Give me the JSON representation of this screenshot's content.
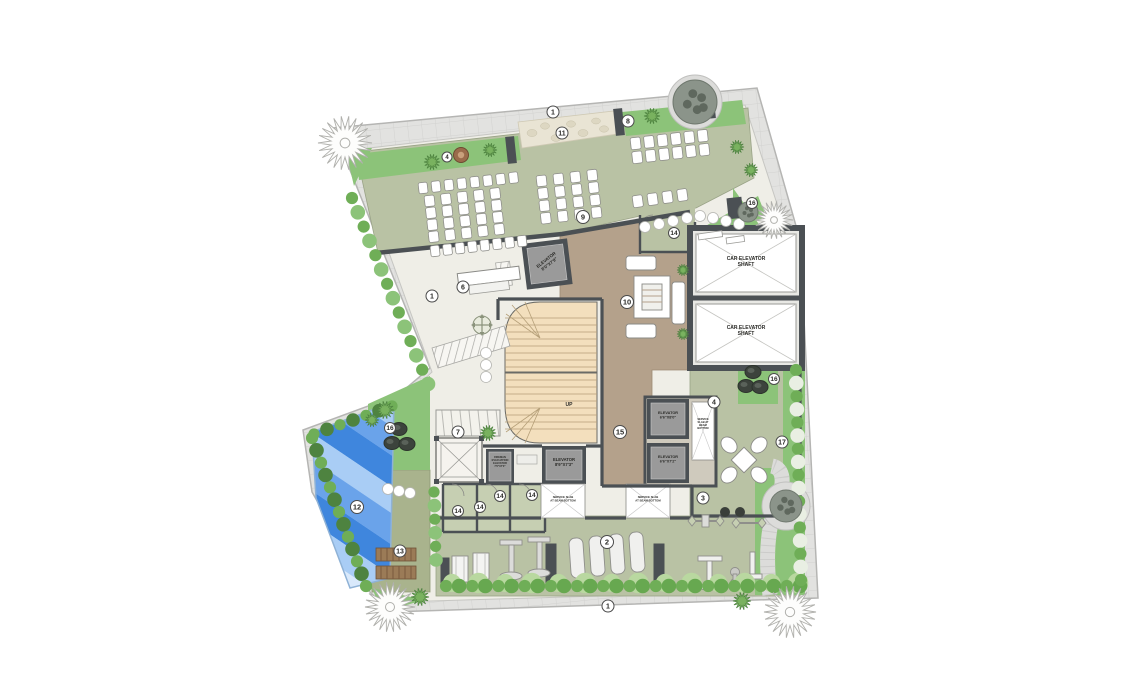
{
  "plan": {
    "type": "architectural-site-floor-plan",
    "colors": {
      "sidewalk": "#e2e2e0",
      "walk": "#efeee7",
      "sage": "#b9c2a4",
      "sage_light": "#c6cfb2",
      "green": "#8cc379",
      "hedge_dark": "#6fae57",
      "hedge_alt": "#4e8340",
      "lawn_ball": "#b9d8a0",
      "tan": "#b4a18b",
      "stairs": "#f3dfbd",
      "wall": "#4b5054",
      "elevator_fill": "#9a9a9a",
      "pool_blues": [
        "#d9e9fb",
        "#a9cdf5",
        "#6aa3ea",
        "#3f86dd"
      ],
      "deck": "#a9b38d",
      "pebble": "#e9e4d4",
      "white": "#ffffff",
      "marker_stroke": "#4a4a4a"
    },
    "markers": [
      {
        "n": "1",
        "x": 553,
        "y": 112,
        "r": 6
      },
      {
        "n": "11",
        "x": 562,
        "y": 133,
        "r": 6
      },
      {
        "n": "8",
        "x": 628,
        "y": 121,
        "r": 6
      },
      {
        "n": "4",
        "x": 447,
        "y": 157,
        "r": 5
      },
      {
        "n": "9",
        "x": 583,
        "y": 217,
        "r": 6.5
      },
      {
        "n": "14",
        "x": 674,
        "y": 233,
        "r": 5.5
      },
      {
        "n": "16",
        "x": 752,
        "y": 203,
        "r": 5.5
      },
      {
        "n": "6",
        "x": 463,
        "y": 287,
        "r": 6
      },
      {
        "n": "1",
        "x": 432,
        "y": 296,
        "r": 6
      },
      {
        "n": "10",
        "x": 627,
        "y": 302,
        "r": 6.5
      },
      {
        "n": "15",
        "x": 620,
        "y": 432,
        "r": 6.5
      },
      {
        "n": "4",
        "x": 714,
        "y": 402,
        "r": 6
      },
      {
        "n": "16",
        "x": 774,
        "y": 379,
        "r": 5.5
      },
      {
        "n": "17",
        "x": 782,
        "y": 442,
        "r": 6
      },
      {
        "n": "14",
        "x": 458,
        "y": 511,
        "r": 5.5
      },
      {
        "n": "14",
        "x": 480,
        "y": 507,
        "r": 5.5
      },
      {
        "n": "14",
        "x": 500,
        "y": 496,
        "r": 5.5
      },
      {
        "n": "14",
        "x": 532,
        "y": 495,
        "r": 5.5
      },
      {
        "n": "3",
        "x": 703,
        "y": 498,
        "r": 6
      },
      {
        "n": "2",
        "x": 607,
        "y": 542,
        "r": 6.5
      },
      {
        "n": "16",
        "x": 390,
        "y": 428,
        "r": 5.5
      },
      {
        "n": "7",
        "x": 458,
        "y": 432,
        "r": 6
      },
      {
        "n": "12",
        "x": 357,
        "y": 507,
        "r": 6.5
      },
      {
        "n": "13",
        "x": 400,
        "y": 551,
        "r": 6
      },
      {
        "n": "1",
        "x": 608,
        "y": 606,
        "r": 6
      }
    ],
    "labels": [
      {
        "id": "car-elevator-shaft-1",
        "text": "CAR ELEVATOR\nSHAFT",
        "x": 746,
        "y": 260,
        "fs": 5,
        "rot": 0
      },
      {
        "id": "car-elevator-shaft-2",
        "text": "CAR ELEVATOR\nSHAFT",
        "x": 746,
        "y": 329,
        "fs": 5,
        "rot": 0
      },
      {
        "id": "elevator-lobby",
        "text": "ELEVATOR\n8'0\"X7'9\"",
        "x": 547,
        "y": 261,
        "fs": 4.4,
        "rot": -38
      },
      {
        "id": "elevator-mid",
        "text": "ELEVATOR\n8'9\"X7'3\"",
        "x": 564,
        "y": 461,
        "fs": 4.2,
        "rot": 0
      },
      {
        "id": "fireman-elevator",
        "text": "FIREMAN\nEVACUATION\nELEVATOR\n7'0\"X7'0\"",
        "x": 500,
        "y": 458,
        "fs": 2.6,
        "rot": 0
      },
      {
        "id": "elevator-right-1",
        "text": "ELEVATOR\n6'6\"X8'0\"",
        "x": 668,
        "y": 414,
        "fs": 3.8,
        "rot": 0
      },
      {
        "id": "elevator-right-2",
        "text": "ELEVATOR\n6'6\"X7'2\"",
        "x": 668,
        "y": 458,
        "fs": 3.8,
        "rot": 0
      },
      {
        "id": "service-slab-1",
        "text": "SERVICE SLAB\nAT BEAM BOTTOM",
        "x": 563,
        "y": 498,
        "fs": 2.8,
        "rot": 0
      },
      {
        "id": "service-slab-2",
        "text": "SERVICE SLAB\nAT BEAM BOTTOM",
        "x": 648,
        "y": 498,
        "fs": 2.8,
        "rot": 0
      },
      {
        "id": "service-slab-3",
        "text": "SERVICE\nSLAB AT\nBEAM\nBOTTOM",
        "x": 703,
        "y": 420,
        "fs": 2.6,
        "rot": 0
      },
      {
        "id": "stair-up",
        "text": "UP",
        "x": 569,
        "y": 406,
        "fs": 5,
        "rot": 0
      }
    ],
    "chair_grids": [
      {
        "x": 418,
        "y": 183,
        "cols": 8,
        "rows": 1,
        "dx": 13,
        "dy": 12,
        "angle": -6.5,
        "w": 9,
        "h": 11
      },
      {
        "x": 424,
        "y": 196,
        "cols": 5,
        "rows": 4,
        "dx": 16.5,
        "dy": 12,
        "angle": -6.5,
        "w": 10,
        "h": 11
      },
      {
        "x": 536,
        "y": 176,
        "cols": 4,
        "rows": 4,
        "dx": 17,
        "dy": 12.5,
        "angle": -6.5,
        "w": 10,
        "h": 11
      },
      {
        "x": 630,
        "y": 138,
        "cols": 6,
        "rows": 2,
        "dx": 13.5,
        "dy": 14,
        "angle": -6.5,
        "w": 10,
        "h": 12
      },
      {
        "x": 632,
        "y": 196,
        "cols": 4,
        "rows": 1,
        "dx": 15,
        "dy": 12,
        "angle": -8,
        "w": 10,
        "h": 12
      },
      {
        "x": 430,
        "y": 246,
        "cols": 8,
        "rows": 1,
        "dx": 12.5,
        "dy": 12,
        "angle": -6.5,
        "w": 9,
        "h": 11
      }
    ],
    "hedges": [
      {
        "x1": 452,
        "y1": 583,
        "x2": 798,
        "y2": 583,
        "step": 26,
        "r": 9.5,
        "colors": [
          "#b9d8a0"
        ]
      },
      {
        "x1": 446,
        "y1": 586,
        "x2": 800,
        "y2": 586,
        "step": 13,
        "r": 6.5,
        "colors": [
          "#6fae57",
          "#67a850"
        ]
      },
      {
        "x1": 796,
        "y1": 370,
        "x2": 801,
        "y2": 580,
        "step": 13,
        "r": 6.5,
        "colors": [
          "#6fae57",
          "#e9efe3"
        ]
      },
      {
        "x1": 312,
        "y1": 438,
        "x2": 366,
        "y2": 586,
        "step": 13,
        "r": 6.5,
        "colors": [
          "#6fae57",
          "#4e8340"
        ]
      },
      {
        "x1": 314,
        "y1": 434,
        "x2": 392,
        "y2": 406,
        "step": 13,
        "r": 6,
        "colors": [
          "#6fae57",
          "#4e8340"
        ]
      },
      {
        "x1": 352,
        "y1": 198,
        "x2": 428,
        "y2": 384,
        "step": 15,
        "r": 6.5,
        "colors": [
          "#6fae57",
          "#8cc379"
        ]
      },
      {
        "x1": 434,
        "y1": 492,
        "x2": 436,
        "y2": 560,
        "step": 13,
        "r": 6,
        "colors": [
          "#6fae57",
          "#8cc379"
        ]
      }
    ],
    "trees": [
      {
        "t": "spiky-white",
        "x": 345,
        "y": 143,
        "r": 27
      },
      {
        "t": "spiky-white",
        "x": 390,
        "y": 607,
        "r": 25
      },
      {
        "t": "spiky-white",
        "x": 790,
        "y": 612,
        "r": 26
      },
      {
        "t": "spiky-white",
        "x": 774,
        "y": 220,
        "r": 19
      },
      {
        "t": "mottled",
        "x": 695,
        "y": 102,
        "r": 22
      },
      {
        "t": "mottled",
        "x": 786,
        "y": 506,
        "r": 16
      },
      {
        "t": "mottled",
        "x": 748,
        "y": 212,
        "r": 10
      },
      {
        "t": "spiky-green",
        "x": 432,
        "y": 162,
        "r": 8
      },
      {
        "t": "spiky-green",
        "x": 490,
        "y": 150,
        "r": 7
      },
      {
        "t": "spiky-green",
        "x": 652,
        "y": 116,
        "r": 8
      },
      {
        "t": "spiky-green",
        "x": 737,
        "y": 147,
        "r": 7
      },
      {
        "t": "spiky-green",
        "x": 751,
        "y": 170,
        "r": 7
      },
      {
        "t": "spiky-green",
        "x": 385,
        "y": 410,
        "r": 9
      },
      {
        "t": "spiky-green",
        "x": 372,
        "y": 420,
        "r": 7
      },
      {
        "t": "spiky-green",
        "x": 420,
        "y": 597,
        "r": 9
      },
      {
        "t": "spiky-green",
        "x": 742,
        "y": 601,
        "r": 9
      },
      {
        "t": "spiky-green",
        "x": 683,
        "y": 270,
        "r": 6
      },
      {
        "t": "spiky-green",
        "x": 683,
        "y": 334,
        "r": 6
      },
      {
        "t": "spiky-green",
        "x": 488,
        "y": 433,
        "r": 8
      }
    ],
    "rocks": [
      {
        "x": 399,
        "y": 429
      },
      {
        "x": 392,
        "y": 443
      },
      {
        "x": 407,
        "y": 444
      },
      {
        "x": 753,
        "y": 372
      },
      {
        "x": 746,
        "y": 386
      },
      {
        "x": 760,
        "y": 387
      }
    ],
    "stones": [
      {
        "x": 645,
        "y": 227
      },
      {
        "x": 659,
        "y": 224
      },
      {
        "x": 673,
        "y": 221
      },
      {
        "x": 687,
        "y": 218
      },
      {
        "x": 700,
        "y": 216
      },
      {
        "x": 713,
        "y": 218
      },
      {
        "x": 726,
        "y": 221
      },
      {
        "x": 739,
        "y": 224
      },
      {
        "x": 388,
        "y": 489
      },
      {
        "x": 399,
        "y": 491
      },
      {
        "x": 410,
        "y": 493
      },
      {
        "x": 486,
        "y": 353
      },
      {
        "x": 486,
        "y": 365
      },
      {
        "x": 486,
        "y": 377
      }
    ],
    "benches": [
      {
        "x": 698,
        "y": 234,
        "w": 24,
        "h": 6,
        "rot": -8
      },
      {
        "x": 726,
        "y": 238,
        "w": 18,
        "h": 6,
        "rot": -8
      }
    ]
  }
}
